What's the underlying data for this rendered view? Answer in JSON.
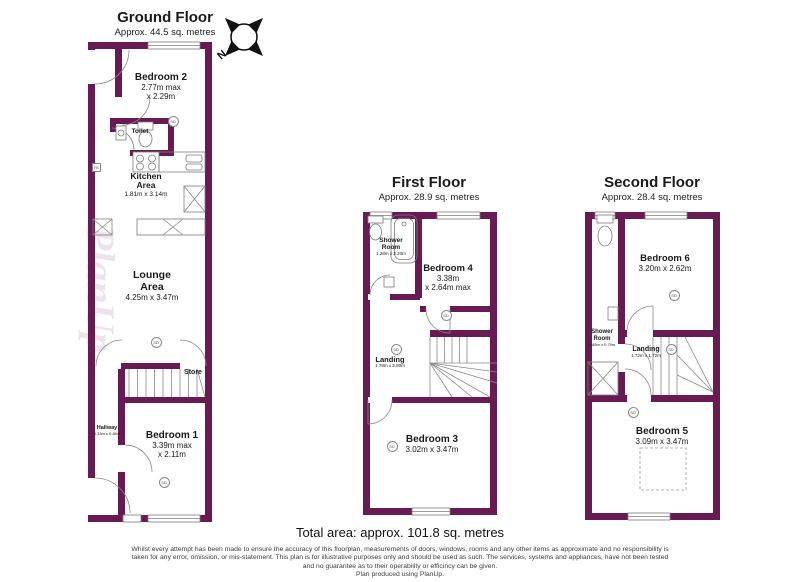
{
  "colors": {
    "wall": "#6a1a52",
    "line": "#8a8a8a"
  },
  "compass": {
    "north_label": "N"
  },
  "floors": {
    "ground": {
      "title": "Ground Floor",
      "subtitle": "Approx. 44.5 sq. metres",
      "rooms": {
        "bedroom2": {
          "name": "Bedroom 2",
          "dim1": "2.77m max",
          "dim2": "x 2.29m"
        },
        "toilet": {
          "name": "Toilet"
        },
        "kitchen": {
          "name": "Kitchen Area",
          "dims": "1.81m x 3.14m"
        },
        "lounge": {
          "name": "Lounge Area",
          "dims": "4.25m x 3.47m"
        },
        "store": {
          "name": "Store"
        },
        "hallway": {
          "name": "Hallway",
          "dims": "4.33m x 0.86m"
        },
        "bedroom1": {
          "name": "Bedroom 1",
          "dim1": "3.39m max",
          "dim2": "x 2.11m"
        }
      }
    },
    "first": {
      "title": "First Floor",
      "subtitle": "Approx. 28.9 sq. metres",
      "rooms": {
        "shower": {
          "name": "Shower Room",
          "dims": "1.28m x 2.20m"
        },
        "bedroom4": {
          "name": "Bedroom 4",
          "dim1": "3.38m",
          "dim2": "x 2.64m max"
        },
        "landing": {
          "name": "Landing",
          "dims": "1.79m x 2.80m"
        },
        "bedroom3": {
          "name": "Bedroom 3",
          "dims": "3.02m x 3.47m"
        }
      }
    },
    "second": {
      "title": "Second Floor",
      "subtitle": "Approx. 28.4 sq. metres",
      "rooms": {
        "bedroom6": {
          "name": "Bedroom 6",
          "dims": "3.20m x 2.62m"
        },
        "shower": {
          "name": "Shower Room",
          "dims": "1.85m x 0.79m"
        },
        "landing": {
          "name": "Landing",
          "dims": "1.72m x 1.72m"
        },
        "bedroom5": {
          "name": "Bedroom 5",
          "dims": "3.09m x 3.47m"
        }
      }
    }
  },
  "markers": {
    "smoke_detector": "SD",
    "fuse_box": "FB"
  },
  "watermark": "PlanUp",
  "footer": {
    "total_area": "Total area: approx. 101.8 sq. metres",
    "disclaimer_lines": [
      "Whilst every attempt has been made to ensure the accuracy of this floorplan, measurements of doors, windows, rooms and any other items as approximate and no responsibility is",
      "taken for any error, omission, or mis-statement. This plan is for illustrative purposes only and should be used as such. The services, systems and appliances, have not been tested",
      "and no guarantee as to their operability or efficincy can be given.",
      "Plan produced using PlanUp."
    ]
  }
}
